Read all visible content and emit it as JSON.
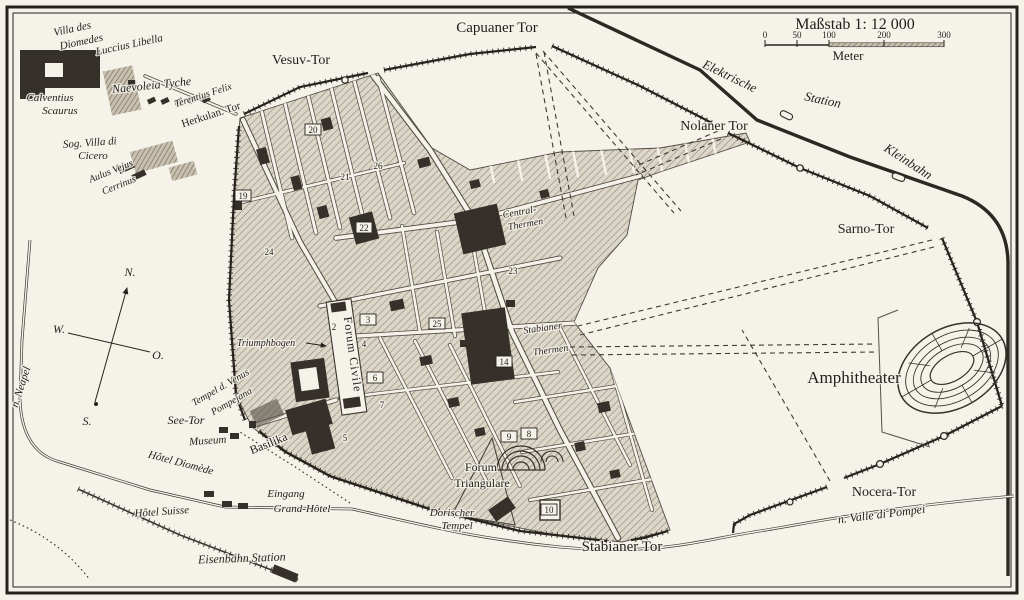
{
  "map": {
    "scale": {
      "title": "Maßstab 1: 12 000",
      "unit": "Meter",
      "ticks": [
        "0",
        "50",
        "100",
        "200",
        "300"
      ]
    },
    "compass": {
      "north": "N.",
      "west": "W.",
      "east": "O.",
      "south": "S."
    },
    "labels": {
      "villa_diomedes_1": "Villa des",
      "villa_diomedes_2": "Diomedes",
      "luccius": "Luccius Libella",
      "naevoleia": "Naevoleia Tyche",
      "calventius_1": "Calventius",
      "calventius_2": "Scaurus",
      "terentius": "Terentius Felix",
      "herkulan_tor": "Herkulan. Tor",
      "sog_villa_1": "Sog. Villa di",
      "sog_villa_2": "Cicero",
      "aulus_1": "Aulus Vejus",
      "aulus_2": "Cerrinus",
      "vesuv_tor": "Vesuv-Tor",
      "capuaner_tor": "Capuaner Tor",
      "elektrische": "Elektrische",
      "station": "Station",
      "nolaner_tor": "Nolaner Tor",
      "kleinbahn": "Kleinbahn",
      "sarno_tor": "Sarno-Tor",
      "amphitheater": "Amphitheater",
      "nocera_tor": "Nocera-Tor",
      "n_valle": "n. Valle di Pompei",
      "stabianer_tor": "Stabianer Tor",
      "n_neapel": "n. Neapel",
      "see_tor": "See-Tor",
      "museum": "Museum",
      "hotel_diomede": "Hôtel Diomède",
      "hotel_suisse": "Hôtel Suisse",
      "eingang": "Eingang",
      "grand_hotel": "Grand-Hôtel",
      "eisenbahn": "Eisenbahn Station",
      "basilika": "Basilika",
      "tempel_venus_1": "Tempel d. Venus",
      "tempel_venus_2": "Pompejana",
      "triumphbogen": "Triumphbogen",
      "forum_civile": "Forum Civile",
      "central_thermen_1": "Central-",
      "central_thermen_2": "Thermen",
      "stabianer_thermen_1": "Stabianer",
      "stabianer_thermen_2": "Thermen",
      "forum_triangulare_1": "Forum",
      "forum_triangulare_2": "Triangulare",
      "dorischer_1": "Dorischer",
      "dorischer_2": "Tempel"
    },
    "markers": [
      {
        "n": "20",
        "x": 313,
        "y": 130,
        "boxed": true
      },
      {
        "n": "26",
        "x": 378,
        "y": 166,
        "boxed": false
      },
      {
        "n": "21",
        "x": 345,
        "y": 177,
        "boxed": false
      },
      {
        "n": "19",
        "x": 243,
        "y": 196,
        "boxed": true
      },
      {
        "n": "22",
        "x": 364,
        "y": 228,
        "boxed": true
      },
      {
        "n": "24",
        "x": 269,
        "y": 252,
        "boxed": false
      },
      {
        "n": "23",
        "x": 513,
        "y": 271,
        "boxed": false
      },
      {
        "n": "3",
        "x": 368,
        "y": 320,
        "boxed": true
      },
      {
        "n": "25",
        "x": 437,
        "y": 324,
        "boxed": true
      },
      {
        "n": "2",
        "x": 334,
        "y": 327,
        "boxed": false
      },
      {
        "n": "4",
        "x": 364,
        "y": 344,
        "boxed": false
      },
      {
        "n": "14",
        "x": 504,
        "y": 362,
        "boxed": true
      },
      {
        "n": "6",
        "x": 375,
        "y": 378,
        "boxed": true
      },
      {
        "n": "7",
        "x": 382,
        "y": 405,
        "boxed": false
      },
      {
        "n": "8",
        "x": 529,
        "y": 434,
        "boxed": true
      },
      {
        "n": "9",
        "x": 509,
        "y": 437,
        "boxed": true
      },
      {
        "n": "5",
        "x": 345,
        "y": 438,
        "boxed": false
      },
      {
        "n": "10",
        "x": 549,
        "y": 510,
        "boxed": true
      }
    ],
    "colors": {
      "paper": "#f5f2ea",
      "ink": "#221f1a",
      "block_hatch": "#8a8273",
      "dark_building": "#35312a"
    }
  }
}
